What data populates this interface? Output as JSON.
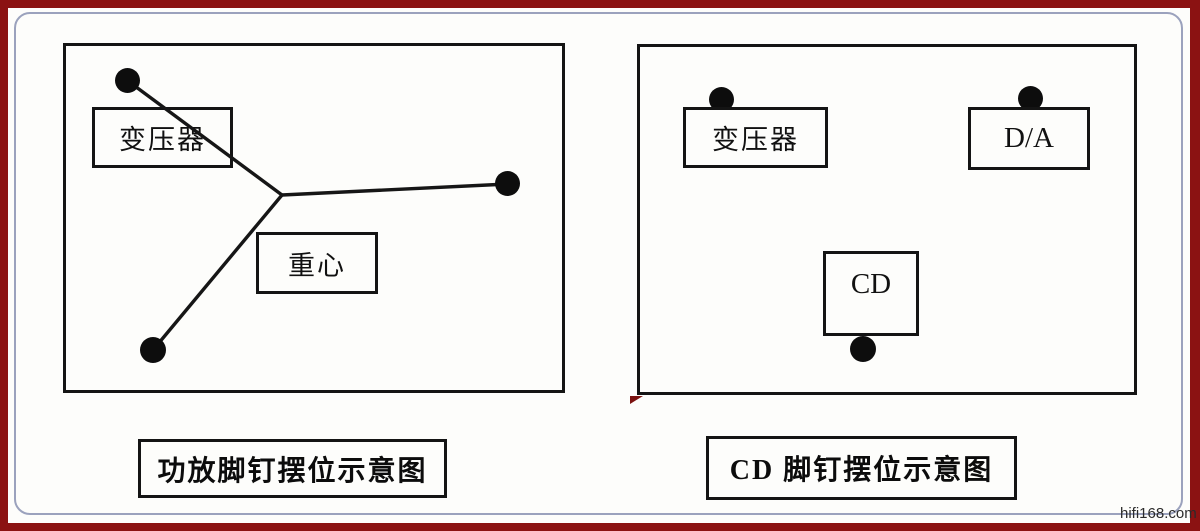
{
  "frame": {
    "outer_border_color": "#8b1212",
    "inner_rule_color": "#9ba2bd",
    "paper_color": "#fdfdfb",
    "ink_color": "#141414"
  },
  "watermark": {
    "text": "hifi168.com",
    "color": "#2b2b2b"
  },
  "diagrams": {
    "amp": {
      "caption": "功放脚钉摆位示意图",
      "transformer_label": "变压器",
      "center_of_gravity_label": "重心",
      "spike_count": 3
    },
    "cd": {
      "caption": "CD 脚钉摆位示意图",
      "transformer_label": "变压器",
      "dac_label": "D/A",
      "cd_label": "CD",
      "spike_count": 3
    }
  }
}
